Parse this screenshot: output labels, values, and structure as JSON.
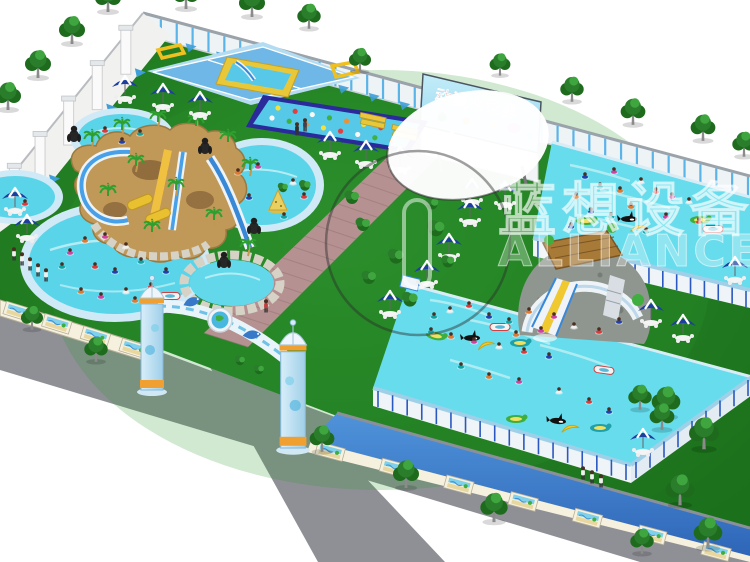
{
  "billboard": {
    "text": "动漫水世界"
  },
  "watermark": {
    "cn": "蓝想设备",
    "en": "ALLIANCE"
  },
  "palette": {
    "lawn": "#1f7c1f",
    "lawn_light": "#2f942f",
    "water": "#5ad4e8",
    "water_deep": "#3fc2dc",
    "pool_rim": "#cfe9f6",
    "frame_side": "#eef4f8",
    "frame_leg": "#2a58c0",
    "sidewalk": "#8f9096",
    "brick_path": "#b59191",
    "fence_post": "#5ab4e8",
    "fence_rail": "#9aa2aa",
    "slope_wall": "#3f7fd0",
    "mural_base": "#f6f1de",
    "mountain": "#c09858",
    "stone": "#d6d2c6",
    "umbrella": "#1c3f9e",
    "tree_dark": "#1e6b1e",
    "tree_mid": "#2a7d2a",
    "tree_light": "#3fa53f",
    "palm_green": "#2f9f2f",
    "slide_blue": "#3888d8",
    "slide_yellow": "#f0c830",
    "billboard_red": "#e02818",
    "goal_yellow": "#f0c020",
    "swimsuit_colors": [
      "#e03838",
      "#2040b0",
      "#10a0a0",
      "#e07830",
      "#d040a0",
      "#f0f0f0"
    ],
    "obstacle_dot_colors": [
      "#f0e040",
      "#e04040",
      "#f8f8f8",
      "#40b040",
      "#f09030"
    ]
  },
  "trees": [
    [
      108,
      10,
      1
    ],
    [
      72,
      42,
      1
    ],
    [
      38,
      76,
      1
    ],
    [
      8,
      108,
      1
    ],
    [
      186,
      7,
      1
    ],
    [
      252,
      15,
      1
    ],
    [
      309,
      27,
      0.9
    ],
    [
      360,
      70,
      0.85
    ],
    [
      500,
      74,
      0.8
    ],
    [
      572,
      100,
      0.9
    ],
    [
      633,
      123,
      0.95
    ],
    [
      703,
      139,
      0.95
    ],
    [
      744,
      155,
      0.9
    ],
    [
      32,
      328,
      0.85
    ],
    [
      96,
      360,
      0.9
    ],
    [
      322,
      450,
      0.95
    ],
    [
      406,
      486,
      1
    ],
    [
      494,
      520,
      1.05
    ],
    [
      666,
      415,
      1.1
    ],
    [
      704,
      447,
      1.15
    ],
    [
      680,
      503,
      1.1
    ],
    [
      708,
      546,
      1.1
    ],
    [
      642,
      552,
      0.9
    ],
    [
      640,
      408,
      0.9
    ],
    [
      662,
      428,
      0.95
    ]
  ],
  "bushes": [
    [
      352,
      198,
      1
    ],
    [
      363,
      225,
      1
    ],
    [
      396,
      257,
      1.1
    ],
    [
      369,
      278,
      1
    ],
    [
      410,
      300,
      1.1
    ],
    [
      436,
      229,
      1.2
    ],
    [
      305,
      186,
      0.8
    ],
    [
      432,
      204,
      0.9
    ],
    [
      240,
      361,
      0.7
    ],
    [
      259,
      370,
      0.7
    ],
    [
      283,
      188,
      0.7
    ],
    [
      448,
      262,
      0.9
    ]
  ],
  "umbrellas": [
    [
      125,
      85
    ],
    [
      163,
      93
    ],
    [
      200,
      101
    ],
    [
      15,
      197
    ],
    [
      27,
      224
    ],
    [
      330,
      141
    ],
    [
      366,
      150
    ],
    [
      400,
      156
    ],
    [
      472,
      188
    ],
    [
      505,
      191
    ],
    [
      470,
      208
    ],
    [
      449,
      243
    ],
    [
      427,
      270
    ],
    [
      390,
      300
    ],
    [
      735,
      266
    ],
    [
      651,
      309
    ],
    [
      683,
      324
    ],
    [
      643,
      438
    ]
  ],
  "palms": [
    [
      92,
      148
    ],
    [
      122,
      136
    ],
    [
      158,
      128
    ],
    [
      196,
      132
    ],
    [
      228,
      148
    ],
    [
      250,
      176
    ],
    [
      136,
      172
    ],
    [
      176,
      196
    ],
    [
      214,
      226
    ],
    [
      248,
      256
    ],
    [
      108,
      202
    ],
    [
      152,
      238
    ]
  ],
  "gorillas": [
    [
      74,
      136
    ],
    [
      205,
      148
    ],
    [
      224,
      262
    ],
    [
      254,
      228
    ]
  ],
  "swimmers": [
    [
      105,
      130
    ],
    [
      122,
      141
    ],
    [
      140,
      133
    ],
    [
      238,
      172
    ],
    [
      258,
      166
    ],
    [
      293,
      182
    ],
    [
      304,
      196
    ],
    [
      249,
      197
    ],
    [
      284,
      216
    ],
    [
      85,
      240
    ],
    [
      105,
      236
    ],
    [
      126,
      246
    ],
    [
      95,
      266
    ],
    [
      115,
      271
    ],
    [
      141,
      261
    ],
    [
      81,
      291
    ],
    [
      101,
      296
    ],
    [
      126,
      291
    ],
    [
      151,
      286
    ],
    [
      166,
      271
    ],
    [
      62,
      266
    ],
    [
      135,
      300
    ],
    [
      70,
      252
    ],
    [
      12,
      195
    ],
    [
      25,
      203
    ],
    [
      585,
      176
    ],
    [
      600,
      186
    ],
    [
      576,
      196
    ],
    [
      614,
      171
    ],
    [
      641,
      181
    ],
    [
      656,
      191
    ],
    [
      591,
      211
    ],
    [
      611,
      216
    ],
    [
      631,
      206
    ],
    [
      666,
      216
    ],
    [
      689,
      201
    ],
    [
      699,
      221
    ],
    [
      571,
      226
    ],
    [
      646,
      231
    ],
    [
      620,
      190
    ],
    [
      672,
      196
    ],
    [
      450,
      310
    ],
    [
      469,
      305
    ],
    [
      489,
      316
    ],
    [
      509,
      321
    ],
    [
      529,
      311
    ],
    [
      554,
      316
    ],
    [
      574,
      326
    ],
    [
      599,
      331
    ],
    [
      619,
      321
    ],
    [
      431,
      331
    ],
    [
      451,
      336
    ],
    [
      474,
      341
    ],
    [
      499,
      346
    ],
    [
      524,
      351
    ],
    [
      549,
      356
    ],
    [
      461,
      366
    ],
    [
      489,
      376
    ],
    [
      519,
      381
    ],
    [
      559,
      391
    ],
    [
      589,
      401
    ],
    [
      609,
      411
    ],
    [
      434,
      316
    ],
    [
      516,
      334
    ],
    [
      541,
      330
    ]
  ],
  "floats": [
    [
      "banana",
      486,
      345,
      -20
    ],
    [
      "orca",
      472,
      338,
      0
    ],
    [
      "raft",
      436,
      336,
      10
    ],
    [
      "raft2",
      520,
      343,
      0
    ],
    [
      "boat",
      604,
      370,
      8
    ],
    [
      "banana",
      570,
      428,
      -15
    ],
    [
      "orca",
      558,
      421,
      5
    ],
    [
      "raft",
      516,
      419,
      0
    ],
    [
      "raft2",
      600,
      428,
      0
    ],
    [
      "boat",
      500,
      327,
      0
    ],
    [
      "orca",
      629,
      219,
      0
    ],
    [
      "banana",
      639,
      228,
      -10
    ],
    [
      "raft",
      586,
      221,
      0
    ],
    [
      "raft",
      700,
      220,
      0
    ],
    [
      "boat",
      713,
      229,
      0
    ],
    [
      "boat",
      170,
      296,
      0
    ],
    [
      "island",
      278,
      206,
      0
    ]
  ],
  "people_standing": [
    [
      297,
      133,
      "#303030"
    ],
    [
      305,
      129,
      "#404050"
    ],
    [
      266,
      310,
      "#c04040"
    ],
    [
      14,
      258,
      "#f0f0f0"
    ],
    [
      22,
      263,
      "#f0f0f0"
    ],
    [
      30,
      268,
      "#f0f0f0"
    ],
    [
      38,
      274,
      "#f0f0f0"
    ],
    [
      46,
      279,
      "#f0f0f0"
    ],
    [
      583,
      477,
      "#f0f0f0"
    ],
    [
      592,
      481,
      "#f0f0f0"
    ],
    [
      601,
      485,
      "#f0f0f0"
    ]
  ]
}
